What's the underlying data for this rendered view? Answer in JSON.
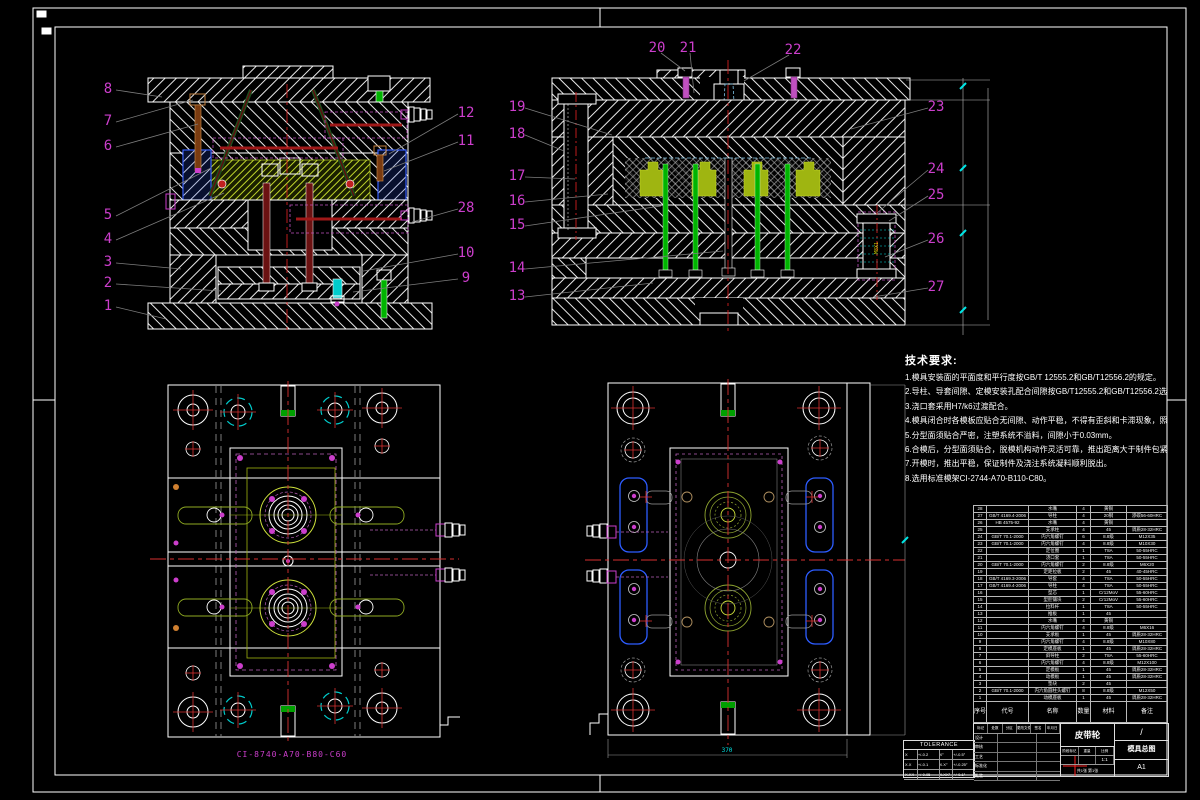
{
  "balloons": [
    "1",
    "2",
    "3",
    "4",
    "5",
    "6",
    "7",
    "8",
    "9",
    "10",
    "11",
    "12",
    "13",
    "14",
    "15",
    "16",
    "17",
    "18",
    "19",
    "20",
    "21",
    "22",
    "23",
    "24",
    "25",
    "26",
    "27",
    "28"
  ],
  "notes": {
    "title": "技术要求:",
    "lines": [
      "1.模具安装面的平面度和平行度按GB/T 12555.2和GB/T12556.2的规定。",
      "2.导柱、导套间隙、定模安装孔配合间隙按GB/T12555.2和GB/T12556.2选取。",
      "3.浇口套采用H7/k6过渡配合。",
      "4.模具闭合时各模板应贴合无间隙、动作平稳，不得有歪斜和卡滞现象，照各制件须符合图样要求。",
      "5.分型面须贴合严密，注塑系统不溢料，间隙小于0.03mm。",
      "6.合模后，分型面须贴合，脱模机构动作灵活可靠，推出距离大于制件包紧高度。",
      "7.开模时，推出平稳，保证制件及浇注系统凝料顺利脱出。",
      "8.选用标准模架CI-2744-A70-B110-C80。"
    ]
  },
  "labels": {
    "mold_base": "CI-8740-A70-B80-C60",
    "dim_370": "370",
    "thread": "M8X1"
  },
  "bom": {
    "headers": [
      "序号",
      "代号",
      "名称",
      "数量",
      "材料",
      "备注"
    ],
    "rows": [
      [
        "28",
        "",
        "水嘴",
        "4",
        "黄铜",
        ""
      ],
      [
        "27",
        "GB/T 4169.4-2006",
        "导柱",
        "4",
        "20钢",
        "渗碳56-60HRC"
      ],
      [
        "26",
        "HB 4575-92",
        "水嘴",
        "4",
        "黄铜",
        ""
      ],
      [
        "25",
        "",
        "支承柱",
        "4",
        "45",
        "调质28-32HRC"
      ],
      [
        "24",
        "GB/T 70.1-2000",
        "内六角螺钉",
        "6",
        "8.8级",
        "M12X35"
      ],
      [
        "23",
        "GB/T 70.1-2000",
        "内六角螺钉",
        "4",
        "8.8级",
        "M10X30"
      ],
      [
        "22",
        "",
        "定位圈",
        "1",
        "T8A",
        "50-55HRC"
      ],
      [
        "21",
        "",
        "浇口套",
        "1",
        "T8A",
        "50-55HRC"
      ],
      [
        "20",
        "GB/T 70.1-2000",
        "内六角螺钉",
        "2",
        "8.8级",
        "M6X20"
      ],
      [
        "19",
        "",
        "定距拉板",
        "2",
        "45",
        "40-45HRC"
      ],
      [
        "18",
        "GB/T 4169.3-2006",
        "导套",
        "4",
        "T8A",
        "50-55HRC"
      ],
      [
        "17",
        "GB/T 4169.4-2006",
        "导柱",
        "4",
        "T8A",
        "50-55HRC"
      ],
      [
        "16",
        "",
        "型芯",
        "1",
        "Cr12MoV",
        "55-60HRC"
      ],
      [
        "15",
        "",
        "型腔镶块",
        "2",
        "Cr12MoV",
        "55-60HRC"
      ],
      [
        "14",
        "",
        "拉料杆",
        "1",
        "T8A",
        "50-55HRC"
      ],
      [
        "13",
        "",
        "推板",
        "1",
        "45",
        ""
      ],
      [
        "12",
        "",
        "水嘴",
        "4",
        "黄铜",
        ""
      ],
      [
        "11",
        "",
        "内六角螺钉",
        "4",
        "8.8级",
        "M6X16"
      ],
      [
        "10",
        "",
        "支承板",
        "1",
        "45",
        "调质28-32HRC"
      ],
      [
        "9",
        "",
        "内六角螺钉",
        "4",
        "8.8级",
        "M10X80"
      ],
      [
        "8",
        "",
        "定模座板",
        "1",
        "45",
        "调质28-32HRC"
      ],
      [
        "7",
        "",
        "斜导柱",
        "2",
        "T8A",
        "55-60HRC"
      ],
      [
        "6",
        "",
        "内六角螺钉",
        "4",
        "8.8级",
        "M12X100"
      ],
      [
        "5",
        "",
        "定模板",
        "1",
        "45",
        "调质28-32HRC"
      ],
      [
        "4",
        "",
        "动模板",
        "1",
        "45",
        "调质28-32HRC"
      ],
      [
        "3",
        "",
        "垫块",
        "2",
        "45",
        ""
      ],
      [
        "2",
        "GB/T 70.1-2000",
        "内六角圆柱头螺钉",
        "8",
        "8.8级",
        "M12X50"
      ],
      [
        "1",
        "",
        "动模座板",
        "1",
        "45",
        "调质28-32HRC"
      ]
    ]
  },
  "tolerance": {
    "title": "TOLERANCE",
    "rows": [
      [
        "X",
        "+/-0.2",
        "X°",
        "+/-0.5°"
      ],
      [
        "X.X",
        "+/-0.1",
        "X.X°",
        "+/-0.25°"
      ],
      [
        "X.XX",
        "+/-0.05",
        "X.XX°",
        "+/-0.1°"
      ]
    ]
  },
  "title_block": {
    "part_name": "皮带轮",
    "doc_name": "模具总图",
    "sheet_size": "A1",
    "slash": "/",
    "stage_label": "阶段标记",
    "weight_label": "重量",
    "scale_label": "比例",
    "scale": "1:1",
    "sheet_note": "共1张 第1张",
    "rev_labels": [
      "标记",
      "处数",
      "分区",
      "更改文件号",
      "签名",
      "年月日"
    ],
    "sign_labels": [
      "设计",
      "审核",
      "工艺",
      "标准化",
      "批准"
    ]
  }
}
